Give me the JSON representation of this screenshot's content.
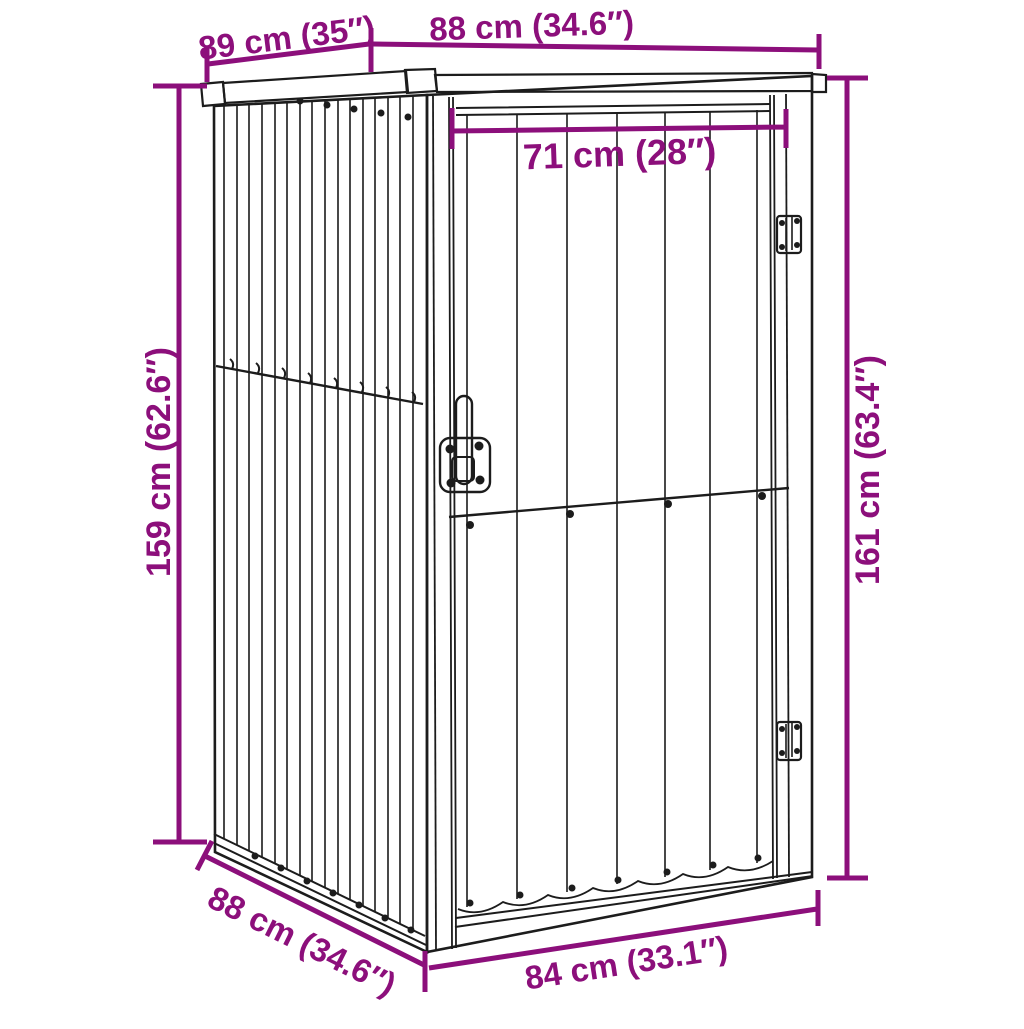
{
  "page": {
    "description": "Perspective line drawing of a metal garden tool shed with purple dimension annotations",
    "background": "#ffffff"
  },
  "colors": {
    "annotation_purple": "#8c0f7b",
    "line_art_black": "#1c1c1c"
  },
  "annotations": {
    "roof_depth": "89 cm (35″)",
    "roof_width": "88 cm (34.6″)",
    "door_width": "71 cm (28″)",
    "left_height": "159 cm (62.6″)",
    "right_height": "161 cm (63.4″)",
    "floor_depth": "88 cm (34.6″)",
    "floor_width": "84 cm (33.1″)"
  }
}
